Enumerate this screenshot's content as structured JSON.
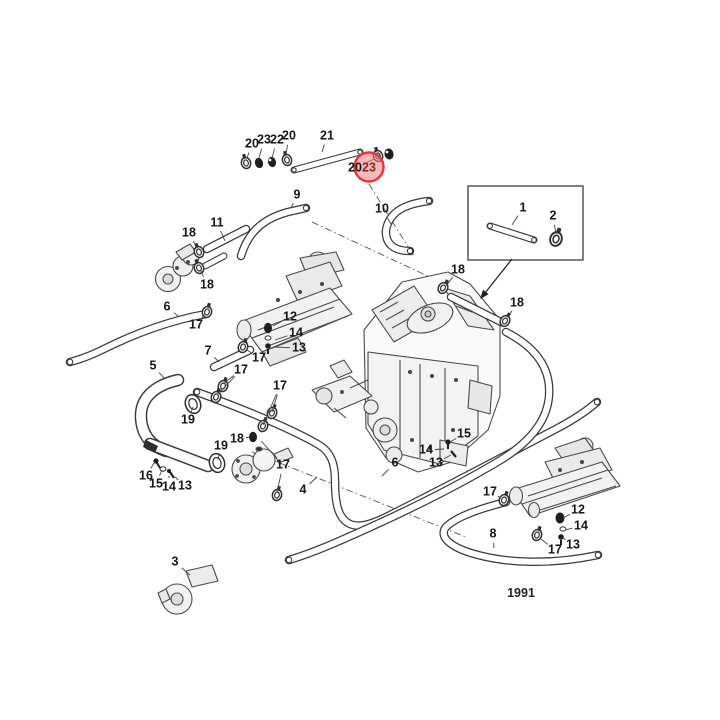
{
  "diagram": {
    "caption": "1991",
    "highlight": {
      "label": "23",
      "cx": 369,
      "cy": 167,
      "r": 14.5,
      "fill": "#f08080",
      "opacity": 0.55,
      "stroke": "#e53935",
      "text_color": "#8e2424"
    },
    "part_callouts": [
      {
        "label": "20",
        "x": 252,
        "y": 144,
        "leaders": [
          [
            247,
            158
          ]
        ]
      },
      {
        "label": "23",
        "x": 264,
        "y": 140,
        "leaders": [
          [
            259,
            158
          ]
        ]
      },
      {
        "label": "22",
        "x": 277,
        "y": 140,
        "leaders": [
          [
            272,
            158
          ]
        ]
      },
      {
        "label": "20",
        "x": 289,
        "y": 136,
        "leaders": [
          [
            286,
            154
          ]
        ]
      },
      {
        "label": "21",
        "x": 327,
        "y": 136,
        "leaders": [
          [
            322,
            152
          ]
        ]
      },
      {
        "label": "20",
        "x": 355,
        "y": 168,
        "leaders": [
          [
            374,
            159
          ]
        ]
      },
      {
        "label": "23",
        "x": 369,
        "y": 168,
        "red": true,
        "leaders": []
      },
      {
        "label": "1",
        "x": 523,
        "y": 208,
        "leaders": [
          [
            512,
            225
          ]
        ]
      },
      {
        "label": "2",
        "x": 553,
        "y": 216,
        "leaders": [
          [
            556,
            234
          ]
        ]
      },
      {
        "label": "9",
        "x": 297,
        "y": 195,
        "leaders": [
          [
            291,
            208
          ]
        ]
      },
      {
        "label": "10",
        "x": 382,
        "y": 209,
        "leaders": [
          [
            391,
            224
          ]
        ]
      },
      {
        "label": "11",
        "x": 217,
        "y": 223,
        "leaders": [
          [
            225,
            241
          ]
        ]
      },
      {
        "label": "18",
        "x": 189,
        "y": 233,
        "leaders": [
          [
            197,
            248
          ]
        ]
      },
      {
        "label": "18",
        "x": 207,
        "y": 285,
        "leaders": [
          [
            201,
            271
          ]
        ]
      },
      {
        "label": "18",
        "x": 458,
        "y": 270,
        "leaders": [
          [
            446,
            286
          ]
        ]
      },
      {
        "label": "18",
        "x": 517,
        "y": 303,
        "leaders": [
          [
            508,
            317
          ]
        ]
      },
      {
        "label": "6",
        "x": 167,
        "y": 307,
        "leaders": [
          [
            178,
            316
          ]
        ]
      },
      {
        "label": "17",
        "x": 196,
        "y": 325,
        "leaders": [
          [
            205,
            314
          ]
        ]
      },
      {
        "label": "12",
        "x": 290,
        "y": 317,
        "leaders": [
          [
            273,
            326
          ]
        ]
      },
      {
        "label": "14",
        "x": 296,
        "y": 333,
        "leaders": [
          [
            275,
            340
          ]
        ]
      },
      {
        "label": "13",
        "x": 299,
        "y": 348,
        "leaders": [
          [
            274,
            347
          ]
        ]
      },
      {
        "label": "7",
        "x": 208,
        "y": 351,
        "leaders": [
          [
            219,
            362
          ]
        ]
      },
      {
        "label": "17",
        "x": 259,
        "y": 358,
        "leaders": [
          [
            247,
            350
          ]
        ]
      },
      {
        "label": "17",
        "x": 241,
        "y": 370,
        "leaders": [
          [
            223,
            384
          ],
          [
            217,
            395
          ]
        ]
      },
      {
        "label": "17",
        "x": 280,
        "y": 386,
        "leaders": [
          [
            272,
            412
          ],
          [
            263,
            425
          ]
        ]
      },
      {
        "label": "5",
        "x": 153,
        "y": 366,
        "leaders": [
          [
            165,
            379
          ]
        ]
      },
      {
        "label": "19",
        "x": 188,
        "y": 420,
        "leaders": [
          [
            193,
            407
          ]
        ]
      },
      {
        "label": "18",
        "x": 237,
        "y": 439,
        "leaders": [
          [
            250,
            437
          ]
        ]
      },
      {
        "label": "19",
        "x": 221,
        "y": 446,
        "leaders": [
          [
            218,
            459
          ]
        ]
      },
      {
        "label": "16",
        "x": 146,
        "y": 476,
        "leaders": [
          [
            154,
            463
          ]
        ]
      },
      {
        "label": "15",
        "x": 156,
        "y": 484,
        "leaders": [
          [
            162,
            470
          ]
        ]
      },
      {
        "label": "14",
        "x": 169,
        "y": 487,
        "leaders": [
          [
            169,
            476
          ]
        ]
      },
      {
        "label": "13",
        "x": 185,
        "y": 486,
        "leaders": [
          [
            175,
            477
          ]
        ]
      },
      {
        "label": "3",
        "x": 175,
        "y": 562,
        "leaders": [
          [
            190,
            575
          ]
        ]
      },
      {
        "label": "4",
        "x": 303,
        "y": 490,
        "leaders": [
          [
            317,
            477
          ]
        ]
      },
      {
        "label": "6",
        "x": 395,
        "y": 463,
        "leaders": [
          [
            382,
            476
          ]
        ]
      },
      {
        "label": "17",
        "x": 283,
        "y": 465,
        "leaders": [
          [
            277,
            492
          ],
          [
            261,
            441
          ]
        ]
      },
      {
        "label": "15",
        "x": 464,
        "y": 434,
        "leaders": [
          [
            450,
            442
          ]
        ]
      },
      {
        "label": "14",
        "x": 426,
        "y": 450,
        "leaders": [
          [
            444,
            449
          ]
        ]
      },
      {
        "label": "13",
        "x": 436,
        "y": 463,
        "leaders": [
          [
            451,
            455
          ]
        ]
      },
      {
        "label": "17",
        "x": 490,
        "y": 492,
        "leaders": [
          [
            501,
            498
          ]
        ]
      },
      {
        "label": "8",
        "x": 493,
        "y": 534,
        "leaders": [
          [
            494,
            548
          ]
        ]
      },
      {
        "label": "12",
        "x": 578,
        "y": 510,
        "leaders": [
          [
            563,
            518
          ]
        ]
      },
      {
        "label": "14",
        "x": 581,
        "y": 526,
        "leaders": [
          [
            565,
            530
          ]
        ]
      },
      {
        "label": "13",
        "x": 573,
        "y": 545,
        "leaders": [
          [
            563,
            538
          ]
        ]
      },
      {
        "label": "17",
        "x": 555,
        "y": 550,
        "leaders": [
          [
            541,
            539
          ]
        ]
      }
    ]
  }
}
